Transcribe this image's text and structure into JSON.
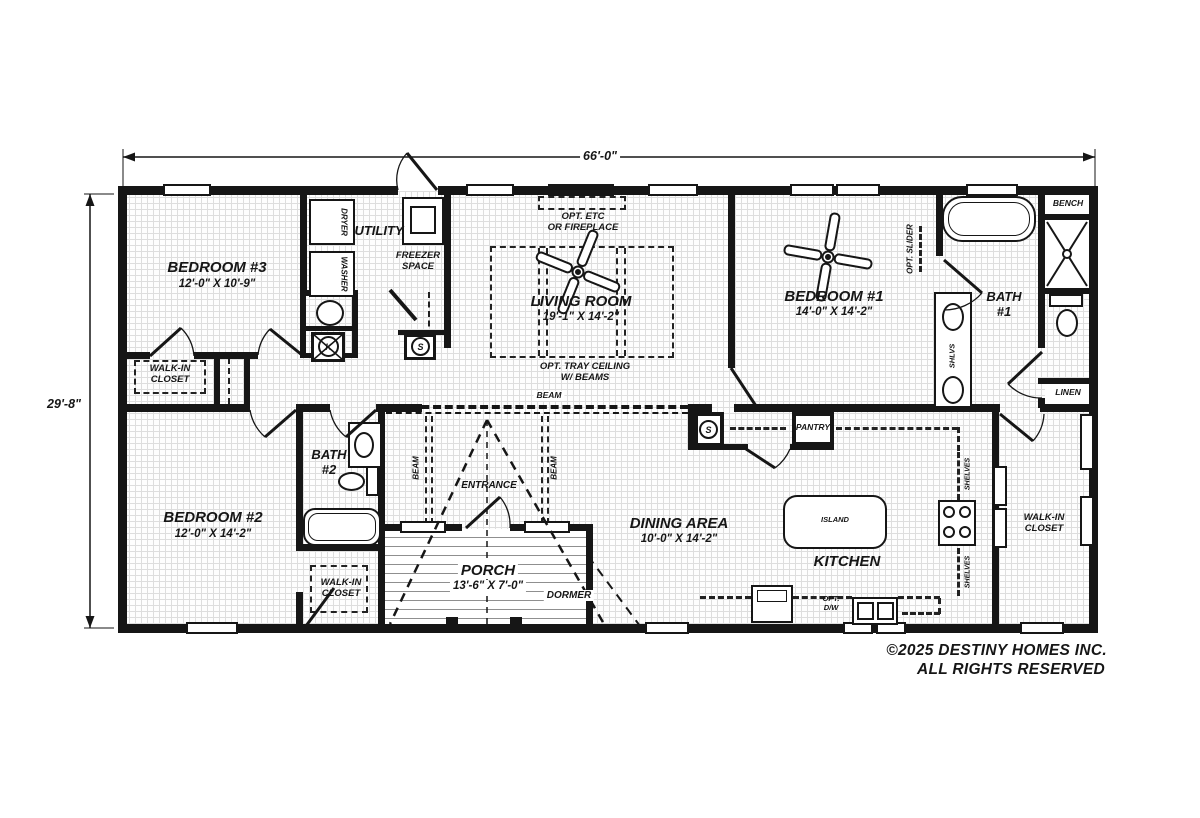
{
  "dimensions": {
    "width": "66'-0\"",
    "height": "29'-8\""
  },
  "rooms": {
    "bedroom3": {
      "name": "BEDROOM #3",
      "dims": "12'-0\" X 10'-9\""
    },
    "utility": {
      "name": "UTILITY"
    },
    "freezer": {
      "name": "FREEZER\nSPACE"
    },
    "living": {
      "name": "LIVING ROOM",
      "dims": "19'-1\" X 14'-2\""
    },
    "bedroom1": {
      "name": "BEDROOM #1",
      "dims": "14'-0\" X 14'-2\""
    },
    "bath1": {
      "name": "BATH\n#1"
    },
    "bedroom2": {
      "name": "BEDROOM #2",
      "dims": "12'-0\" X 14'-2\""
    },
    "bath2": {
      "name": "BATH\n#2"
    },
    "dining": {
      "name": "DINING AREA",
      "dims": "10'-0\" X 14'-2\""
    },
    "kitchen": {
      "name": "KITCHEN"
    },
    "porch": {
      "name": "PORCH",
      "dims": "13'-6\" X 7'-0\""
    },
    "walk_in_closet": {
      "name": "WALK-IN\nCLOSET"
    }
  },
  "labels": {
    "opt_etc": "OPT. ETC\nOR FIREPLACE",
    "opt_tray": "OPT. TRAY CEILING\nW/ BEAMS",
    "beam": "BEAM",
    "entrance": "ENTRANCE",
    "dormer": "DORMER",
    "pantry": "PANTRY",
    "island": "ISLAND",
    "bench": "BENCH",
    "linen": "LINEN",
    "shlvs": "SHLVS",
    "shelves": "SHELVES",
    "opt_dw": "OPT.\nD/W",
    "opt_slider": "OPT. SLIDER",
    "dryer": "DRYER",
    "washer": "WASHER"
  },
  "symbols": {
    "smoke": "S",
    "heater": "K"
  },
  "footer": {
    "line1": "©2025 DESTINY HOMES INC.",
    "line2": "ALL RIGHTS RESERVED"
  }
}
